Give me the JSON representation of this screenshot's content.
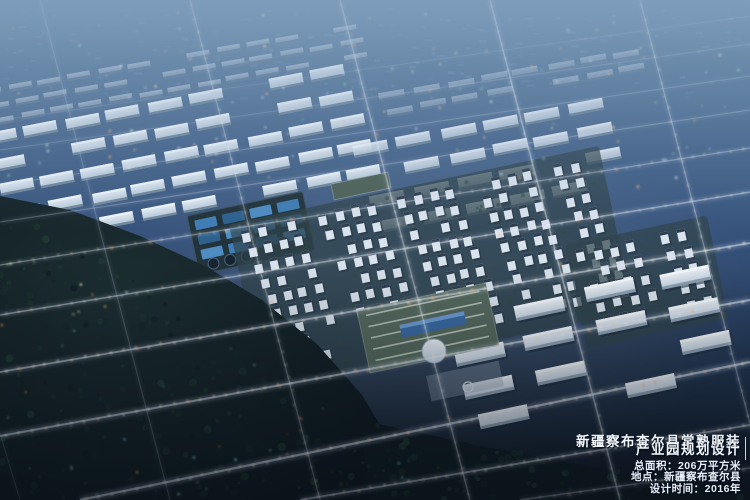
{
  "overlay": {
    "title_line1": "新疆察布查尔县常熟服装",
    "title_line2": "产业园规划设计",
    "stats": [
      "总面积：206万平方米",
      "地点：新疆察布查尔县",
      "设计时间：2016年"
    ]
  },
  "colors": {
    "sky_top": "#7e9cb8",
    "haze": "#7e9cbe",
    "ground_dark": "#101823",
    "forest": "#16262a",
    "building_wall": "#dbe5ee",
    "building_roof": "#2e3e50",
    "factory_roof_green": "#55695e",
    "glass_blue": "#3a6aa2",
    "pond_blue": "#3f7db4",
    "road_glow": "#cdd9ee",
    "street_light_warm": "#ffe9c4",
    "light_orange": "#ffb066",
    "light_cyan": "#cfe8ff",
    "light_green": "#a2ecb2",
    "text_color": "#f3f7fc"
  },
  "scene": {
    "roads_a": [
      [
        0,
        120,
        750,
        16,
        0.14,
        0.8
      ],
      [
        0,
        150,
        750,
        44,
        0.18,
        0.9
      ],
      [
        0,
        185,
        750,
        76,
        0.22,
        1
      ],
      [
        0,
        222,
        750,
        110,
        0.26,
        1.1
      ],
      [
        0,
        265,
        750,
        148,
        0.34,
        1.3
      ],
      [
        0,
        315,
        750,
        192,
        0.44,
        1.5
      ],
      [
        0,
        372,
        750,
        243,
        0.5,
        1.8
      ],
      [
        0,
        436,
        750,
        300,
        0.55,
        2
      ],
      [
        80,
        500,
        750,
        362,
        0.6,
        2.2
      ],
      [
        300,
        500,
        750,
        425,
        0.5,
        1.8
      ],
      [
        520,
        500,
        750,
        468,
        0.35,
        1.4
      ]
    ],
    "roads_b": [
      [
        20,
        500,
        -130,
        0,
        0.15,
        0.8
      ],
      [
        170,
        500,
        40,
        0,
        0.2,
        1
      ],
      [
        320,
        500,
        190,
        0,
        0.3,
        1.2
      ],
      [
        470,
        500,
        340,
        0,
        0.4,
        1.4
      ],
      [
        620,
        500,
        490,
        0,
        0.45,
        1.5
      ],
      [
        770,
        500,
        640,
        0,
        0.35,
        1.2
      ],
      [
        920,
        500,
        790,
        0,
        0.2,
        0.9
      ]
    ],
    "warehouse_blocks": [
      {
        "x": -10,
        "y": 98,
        "rows": 5,
        "cols": 9,
        "dx": 42,
        "dy": 26,
        "rowShift": 4,
        "w": 34,
        "h": 12,
        "angle": -11,
        "opacity": 1
      },
      {
        "x": 360,
        "y": 120,
        "rows": 4,
        "cols": 6,
        "dx": 44,
        "dy": 26,
        "rowShift": 4,
        "w": 35,
        "h": 12,
        "angle": -11,
        "opacity": 0.9
      },
      {
        "x": -20,
        "y": 56,
        "rows": 3,
        "cols": 13,
        "dx": 30,
        "dy": 15,
        "rowShift": 3,
        "w": 23,
        "h": 7,
        "angle": -10,
        "opacity": 0.45
      },
      {
        "x": 380,
        "y": 70,
        "rows": 2,
        "cols": 8,
        "dx": 34,
        "dy": 16,
        "rowShift": 3,
        "w": 26,
        "h": 8,
        "angle": -10,
        "opacity": 0.4
      }
    ],
    "ponds": {
      "x": 192,
      "y": 203,
      "w": 118,
      "h": 60,
      "angle": -12
    },
    "residential_blocks": [
      {
        "x": 252,
        "y": 192,
        "rows": 9,
        "cols": 22,
        "dx": 16,
        "dy": 16.5,
        "rowShift": 3,
        "w": 8,
        "h": 12,
        "angle": -12
      },
      {
        "x": 584,
        "y": 238,
        "rows": 5,
        "cols": 7,
        "dx": 17,
        "dy": 17,
        "rowShift": 3,
        "w": 8,
        "h": 12,
        "angle": -12
      }
    ],
    "campus_blocks": [
      {
        "x": 450,
        "y": 288,
        "rows": 4,
        "cols": 4,
        "dx": 74,
        "dy": 34,
        "rowShift": 6,
        "w": 50,
        "h": 15,
        "angle": -12,
        "opacity": 1
      }
    ],
    "landmarks": {
      "commercial": {
        "x": 332,
        "y": 178,
        "w": 58,
        "h": 16,
        "angle": -12
      },
      "bigroof": {
        "x": 362,
        "y": 296,
        "w": 132,
        "h": 64,
        "angle": -12
      },
      "glass": {
        "x": 400,
        "y": 318,
        "w": 66,
        "h": 13,
        "angle": -12
      },
      "dome": {
        "cx": 434,
        "cy": 351,
        "r": 12
      },
      "plaza": {
        "x": 428,
        "y": 368,
        "w": 74,
        "h": 26,
        "angle": -12
      },
      "fountain": {
        "cx": 468,
        "cy": 387,
        "r": 5
      }
    },
    "forest_main": "0,196 70,210 140,236 205,266 262,300 318,345 362,395 395,450 405,500 0,500",
    "forest_strip": "360,420 480,446 620,472 750,492 750,500 370,500"
  }
}
